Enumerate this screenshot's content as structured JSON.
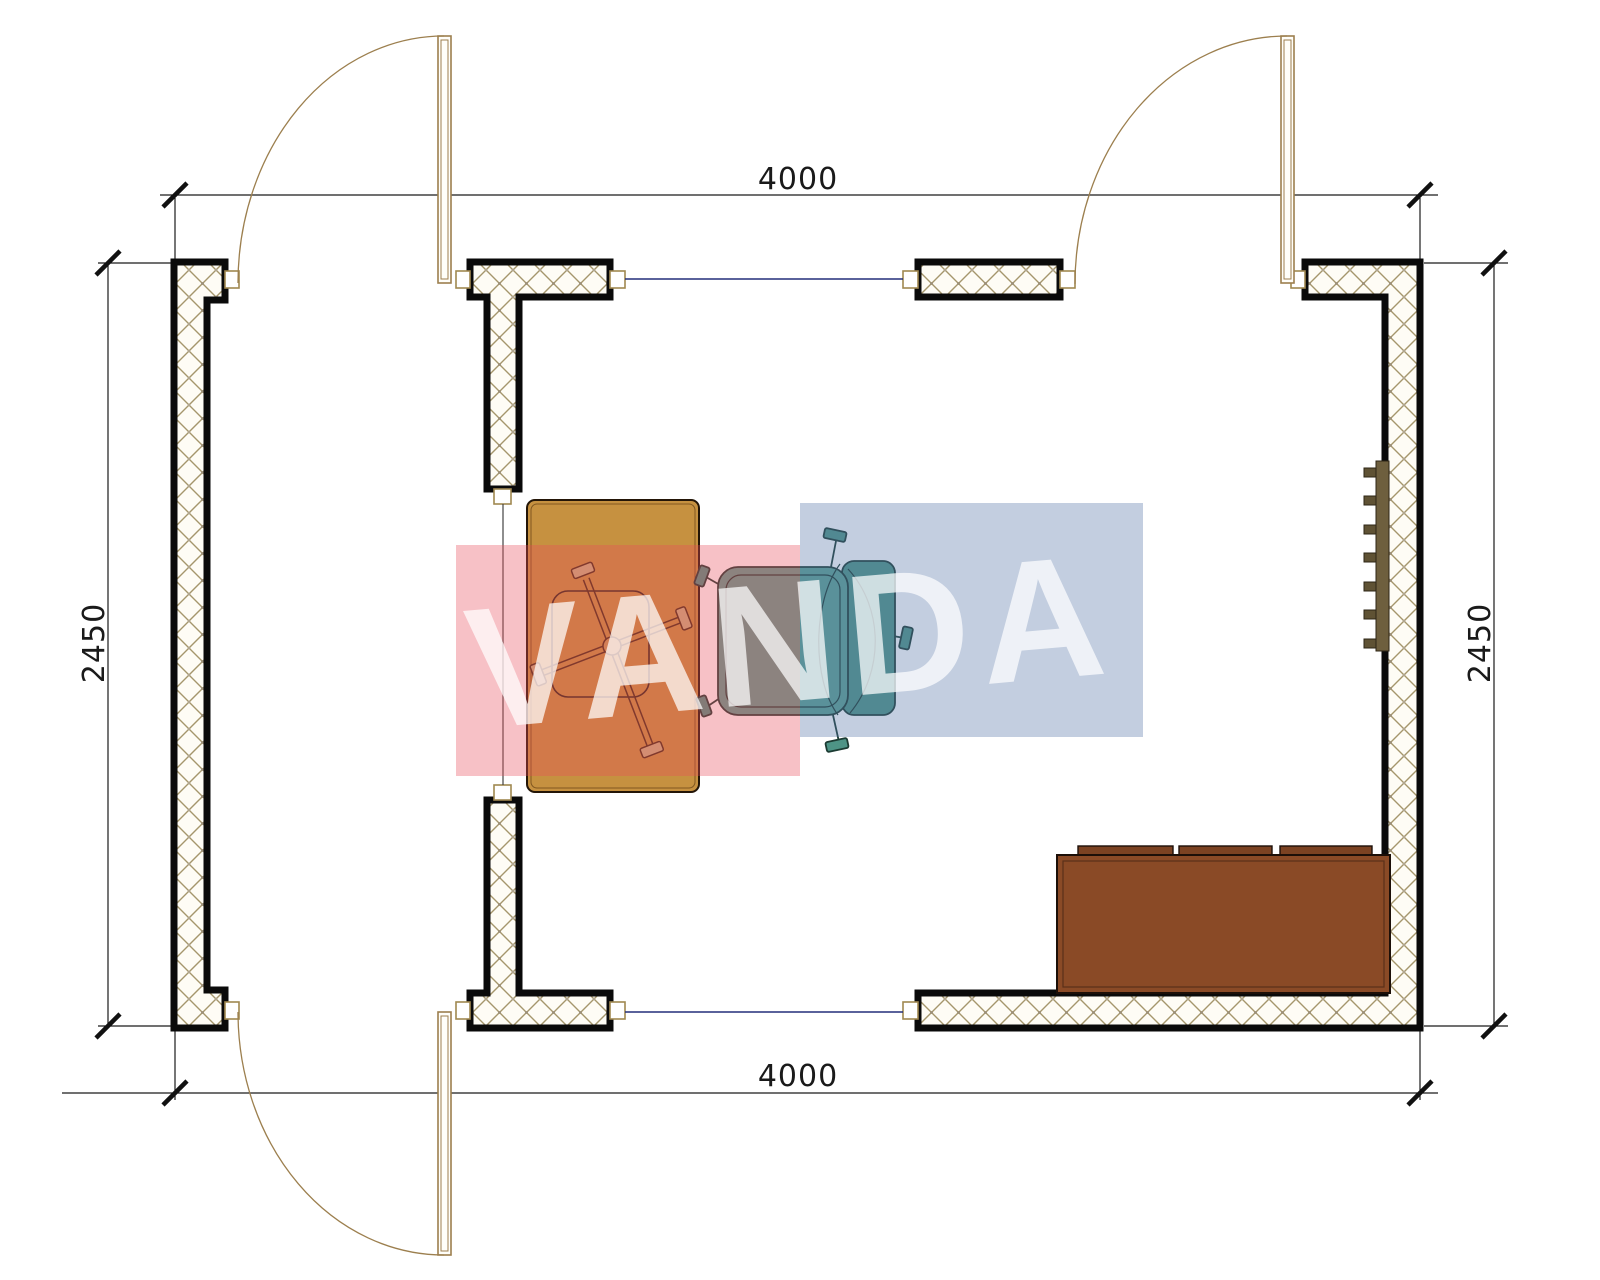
{
  "plan": {
    "title": "floor-plan",
    "dimensions": {
      "top": "4000",
      "bottom": "4000",
      "left": "2450",
      "right": "2450"
    },
    "watermark": {
      "text": "VANDA",
      "pink": "rgba(232,77,93,0.35)",
      "blue": "rgba(88,118,168,0.36)",
      "text_color": "rgba(255,255,255,0.72)"
    },
    "colors": {
      "wall_outline": "#0a0a0a",
      "hatch_line": "#a5966c",
      "desk": "#c69140",
      "chair_seat": "#5ba092",
      "chair_back": "#4e9486",
      "sofa": "#8a4a26",
      "sofa_cushion": "#7b4222",
      "radiator_bar": "#6e5f3e",
      "radiator_fin": "#5f5234",
      "door": "#9c7f4e",
      "window_line": "#232e7a",
      "dimension": "#1a1a1a"
    }
  }
}
